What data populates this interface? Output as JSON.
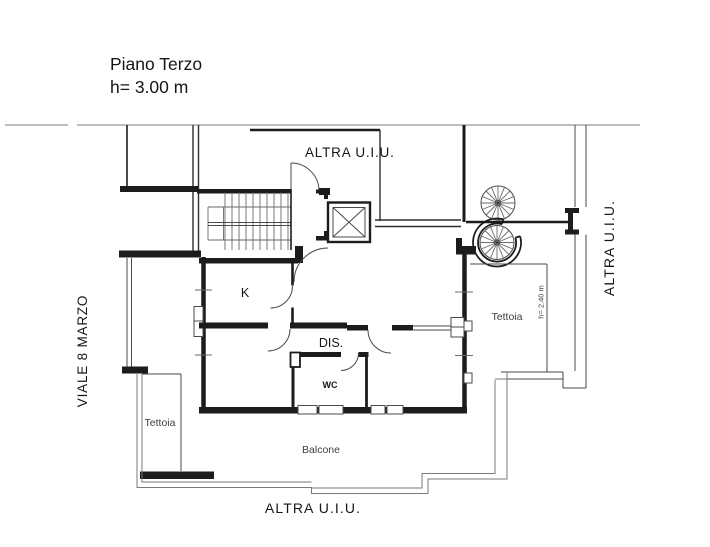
{
  "title": {
    "line1": "Piano Terzo",
    "line2": "h= 3.00 m"
  },
  "labels": {
    "unit_top": "ALTRA U.I.U.",
    "unit_right": "ALTRA U.I.U.",
    "unit_bottom": "ALTRA U.I.U.",
    "street": "VIALE 8 MARZO",
    "kitchen": "K",
    "hall": "DIS.",
    "wc": "WC",
    "canopy_right": "Tettoia",
    "canopy_left": "Tettoia",
    "canopy_height": "h= 2.40 m",
    "balcony": "Balcone"
  },
  "colors": {
    "wall": "#1c1c1c",
    "thin_line": "#4a4a4a",
    "rail_line": "#7a7a7a",
    "boundary_line": "#a8a8a8",
    "text_dark": "#161616",
    "text_gray": "#3f3f3f",
    "background": "#ffffff"
  }
}
